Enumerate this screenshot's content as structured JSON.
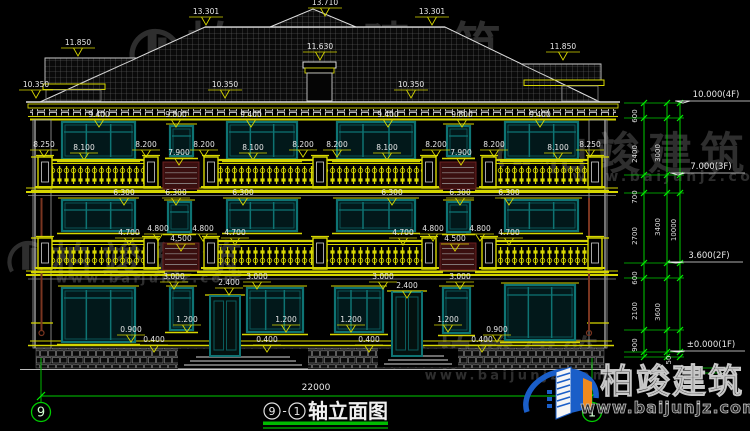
{
  "title": {
    "axis_left": "9",
    "axis_right": "1",
    "sep": "-",
    "name": "轴立面图"
  },
  "footer": {
    "total_width": "22000"
  },
  "watermark": {
    "brand": "柏竣建筑",
    "url": "www.baijunjz.com"
  },
  "logo": {
    "brand": "柏竣建筑",
    "url": "www.baijunjz.com"
  },
  "colors": {
    "cad_yellow": "#d6d600",
    "cad_white": "#e8e8e8",
    "cad_green": "#00cc00",
    "window_teal": "#0e7373",
    "maroon_panel": "#5a1616",
    "downspout_brown": "#7a3520",
    "watermark_gray": "#9a9a9a",
    "logo_blue": "#1a5ec8",
    "logo_orange": "#f08a1e"
  },
  "roof_marks": [
    {
      "t": "13.710",
      "x": 325,
      "y": 5
    },
    {
      "t": "13.301",
      "x": 206,
      "y": 14
    },
    {
      "t": "13.301",
      "x": 432,
      "y": 14
    },
    {
      "t": "11.850",
      "x": 78,
      "y": 45
    },
    {
      "t": "11.850",
      "x": 563,
      "y": 49
    },
    {
      "t": "11.630",
      "x": 320,
      "y": 49
    },
    {
      "t": "10.350",
      "x": 36,
      "y": 87
    },
    {
      "t": "10.350",
      "x": 225,
      "y": 87
    },
    {
      "t": "10.350",
      "x": 411,
      "y": 87
    }
  ],
  "dims": [
    {
      "t": "9.400",
      "x": 99,
      "y": 117
    },
    {
      "t": "9.800",
      "x": 176,
      "y": 117
    },
    {
      "t": "9.400",
      "x": 251,
      "y": 117
    },
    {
      "t": "9.400",
      "x": 388,
      "y": 117
    },
    {
      "t": "9.800",
      "x": 462,
      "y": 117
    },
    {
      "t": "9.400",
      "x": 540,
      "y": 117
    },
    {
      "t": "8.250",
      "x": 44,
      "y": 147
    },
    {
      "t": "8.100",
      "x": 84,
      "y": 150
    },
    {
      "t": "8.200",
      "x": 146,
      "y": 147
    },
    {
      "t": "7.900",
      "x": 179,
      "y": 155
    },
    {
      "t": "8.200",
      "x": 204,
      "y": 147
    },
    {
      "t": "8.100",
      "x": 253,
      "y": 150
    },
    {
      "t": "8.200",
      "x": 303,
      "y": 147
    },
    {
      "t": "8.200",
      "x": 337,
      "y": 147
    },
    {
      "t": "8.100",
      "x": 387,
      "y": 150
    },
    {
      "t": "8.200",
      "x": 436,
      "y": 147
    },
    {
      "t": "7.900",
      "x": 461,
      "y": 155
    },
    {
      "t": "8.200",
      "x": 494,
      "y": 147
    },
    {
      "t": "8.100",
      "x": 558,
      "y": 150
    },
    {
      "t": "8.250",
      "x": 590,
      "y": 147
    },
    {
      "t": "6.300",
      "x": 124,
      "y": 195
    },
    {
      "t": "6.300",
      "x": 176,
      "y": 195
    },
    {
      "t": "6.300",
      "x": 243,
      "y": 195
    },
    {
      "t": "6.300",
      "x": 392,
      "y": 195
    },
    {
      "t": "6.300",
      "x": 460,
      "y": 195
    },
    {
      "t": "6.300",
      "x": 509,
      "y": 195
    },
    {
      "t": "4.700",
      "x": 129,
      "y": 235
    },
    {
      "t": "4.800",
      "x": 158,
      "y": 231
    },
    {
      "t": "4.500",
      "x": 181,
      "y": 241
    },
    {
      "t": "4.800",
      "x": 203,
      "y": 231
    },
    {
      "t": "4.700",
      "x": 235,
      "y": 235
    },
    {
      "t": "4.700",
      "x": 403,
      "y": 235
    },
    {
      "t": "4.800",
      "x": 433,
      "y": 231
    },
    {
      "t": "4.500",
      "x": 455,
      "y": 241
    },
    {
      "t": "4.800",
      "x": 480,
      "y": 231
    },
    {
      "t": "4.700",
      "x": 509,
      "y": 235
    },
    {
      "t": "3.000",
      "x": 174,
      "y": 279
    },
    {
      "t": "3.000",
      "x": 257,
      "y": 279
    },
    {
      "t": "3.000",
      "x": 383,
      "y": 279
    },
    {
      "t": "3.000",
      "x": 460,
      "y": 279
    },
    {
      "t": "2.400",
      "x": 229,
      "y": 285
    },
    {
      "t": "2.400",
      "x": 407,
      "y": 288
    },
    {
      "t": "1.200",
      "x": 187,
      "y": 322
    },
    {
      "t": "1.200",
      "x": 286,
      "y": 322
    },
    {
      "t": "1.200",
      "x": 351,
      "y": 322
    },
    {
      "t": "1.200",
      "x": 448,
      "y": 322
    },
    {
      "t": "0.900",
      "x": 131,
      "y": 332
    },
    {
      "t": "0.900",
      "x": 497,
      "y": 332
    },
    {
      "t": "0.400",
      "x": 154,
      "y": 342
    },
    {
      "t": "0.400",
      "x": 267,
      "y": 342
    },
    {
      "t": "0.400",
      "x": 369,
      "y": 342
    },
    {
      "t": "0.400",
      "x": 482,
      "y": 342
    }
  ],
  "chain_dims": [
    {
      "t": "600",
      "x": 637,
      "y": 116
    },
    {
      "t": "2400",
      "x": 637,
      "y": 154
    },
    {
      "t": "700",
      "x": 637,
      "y": 197
    },
    {
      "t": "2700",
      "x": 637,
      "y": 236
    },
    {
      "t": "600",
      "x": 637,
      "y": 278
    },
    {
      "t": "2100",
      "x": 637,
      "y": 311
    },
    {
      "t": "900",
      "x": 637,
      "y": 345
    },
    {
      "t": "3000",
      "x": 660,
      "y": 153
    },
    {
      "t": "3400",
      "x": 660,
      "y": 227
    },
    {
      "t": "3600",
      "x": 660,
      "y": 312
    },
    {
      "t": "10000",
      "x": 676,
      "y": 230
    },
    {
      "t": "50",
      "x": 671,
      "y": 360
    }
  ],
  "levels": [
    {
      "t": "10.000(4F)",
      "x": 716,
      "y": 97,
      "ly": 103
    },
    {
      "t": "7.000(3F)",
      "x": 711,
      "y": 169,
      "ly": 175
    },
    {
      "t": "3.600(2F)",
      "x": 709,
      "y": 258,
      "ly": 263
    },
    {
      "t": "±0.000(1F)",
      "x": 711,
      "y": 347,
      "ly": 352
    }
  ],
  "watermarks": [
    {
      "cx": 363,
      "cy": 46,
      "size": 50,
      "spacing": 38,
      "ux": 270,
      "uy": 71,
      "usize": 15,
      "gx": 155,
      "gy": 50,
      "gs": 52
    },
    {
      "cx": 648,
      "cy": 153,
      "size": 44,
      "spacing": 8,
      "ux": 672,
      "uy": 176,
      "usize": 14,
      "gx": 520,
      "gy": 152,
      "gs": 46
    },
    {
      "cx": 152,
      "cy": 260,
      "size": 40,
      "spacing": 10,
      "ux": 148,
      "uy": 278,
      "usize": 13,
      "gx": 28,
      "gy": 258,
      "gs": 42
    },
    {
      "cx": 521,
      "cy": 353,
      "size": 35,
      "spacing": 7,
      "ux": 517,
      "uy": 375,
      "usize": 13,
      "gx": 410,
      "gy": 356,
      "gs": 38
    }
  ]
}
